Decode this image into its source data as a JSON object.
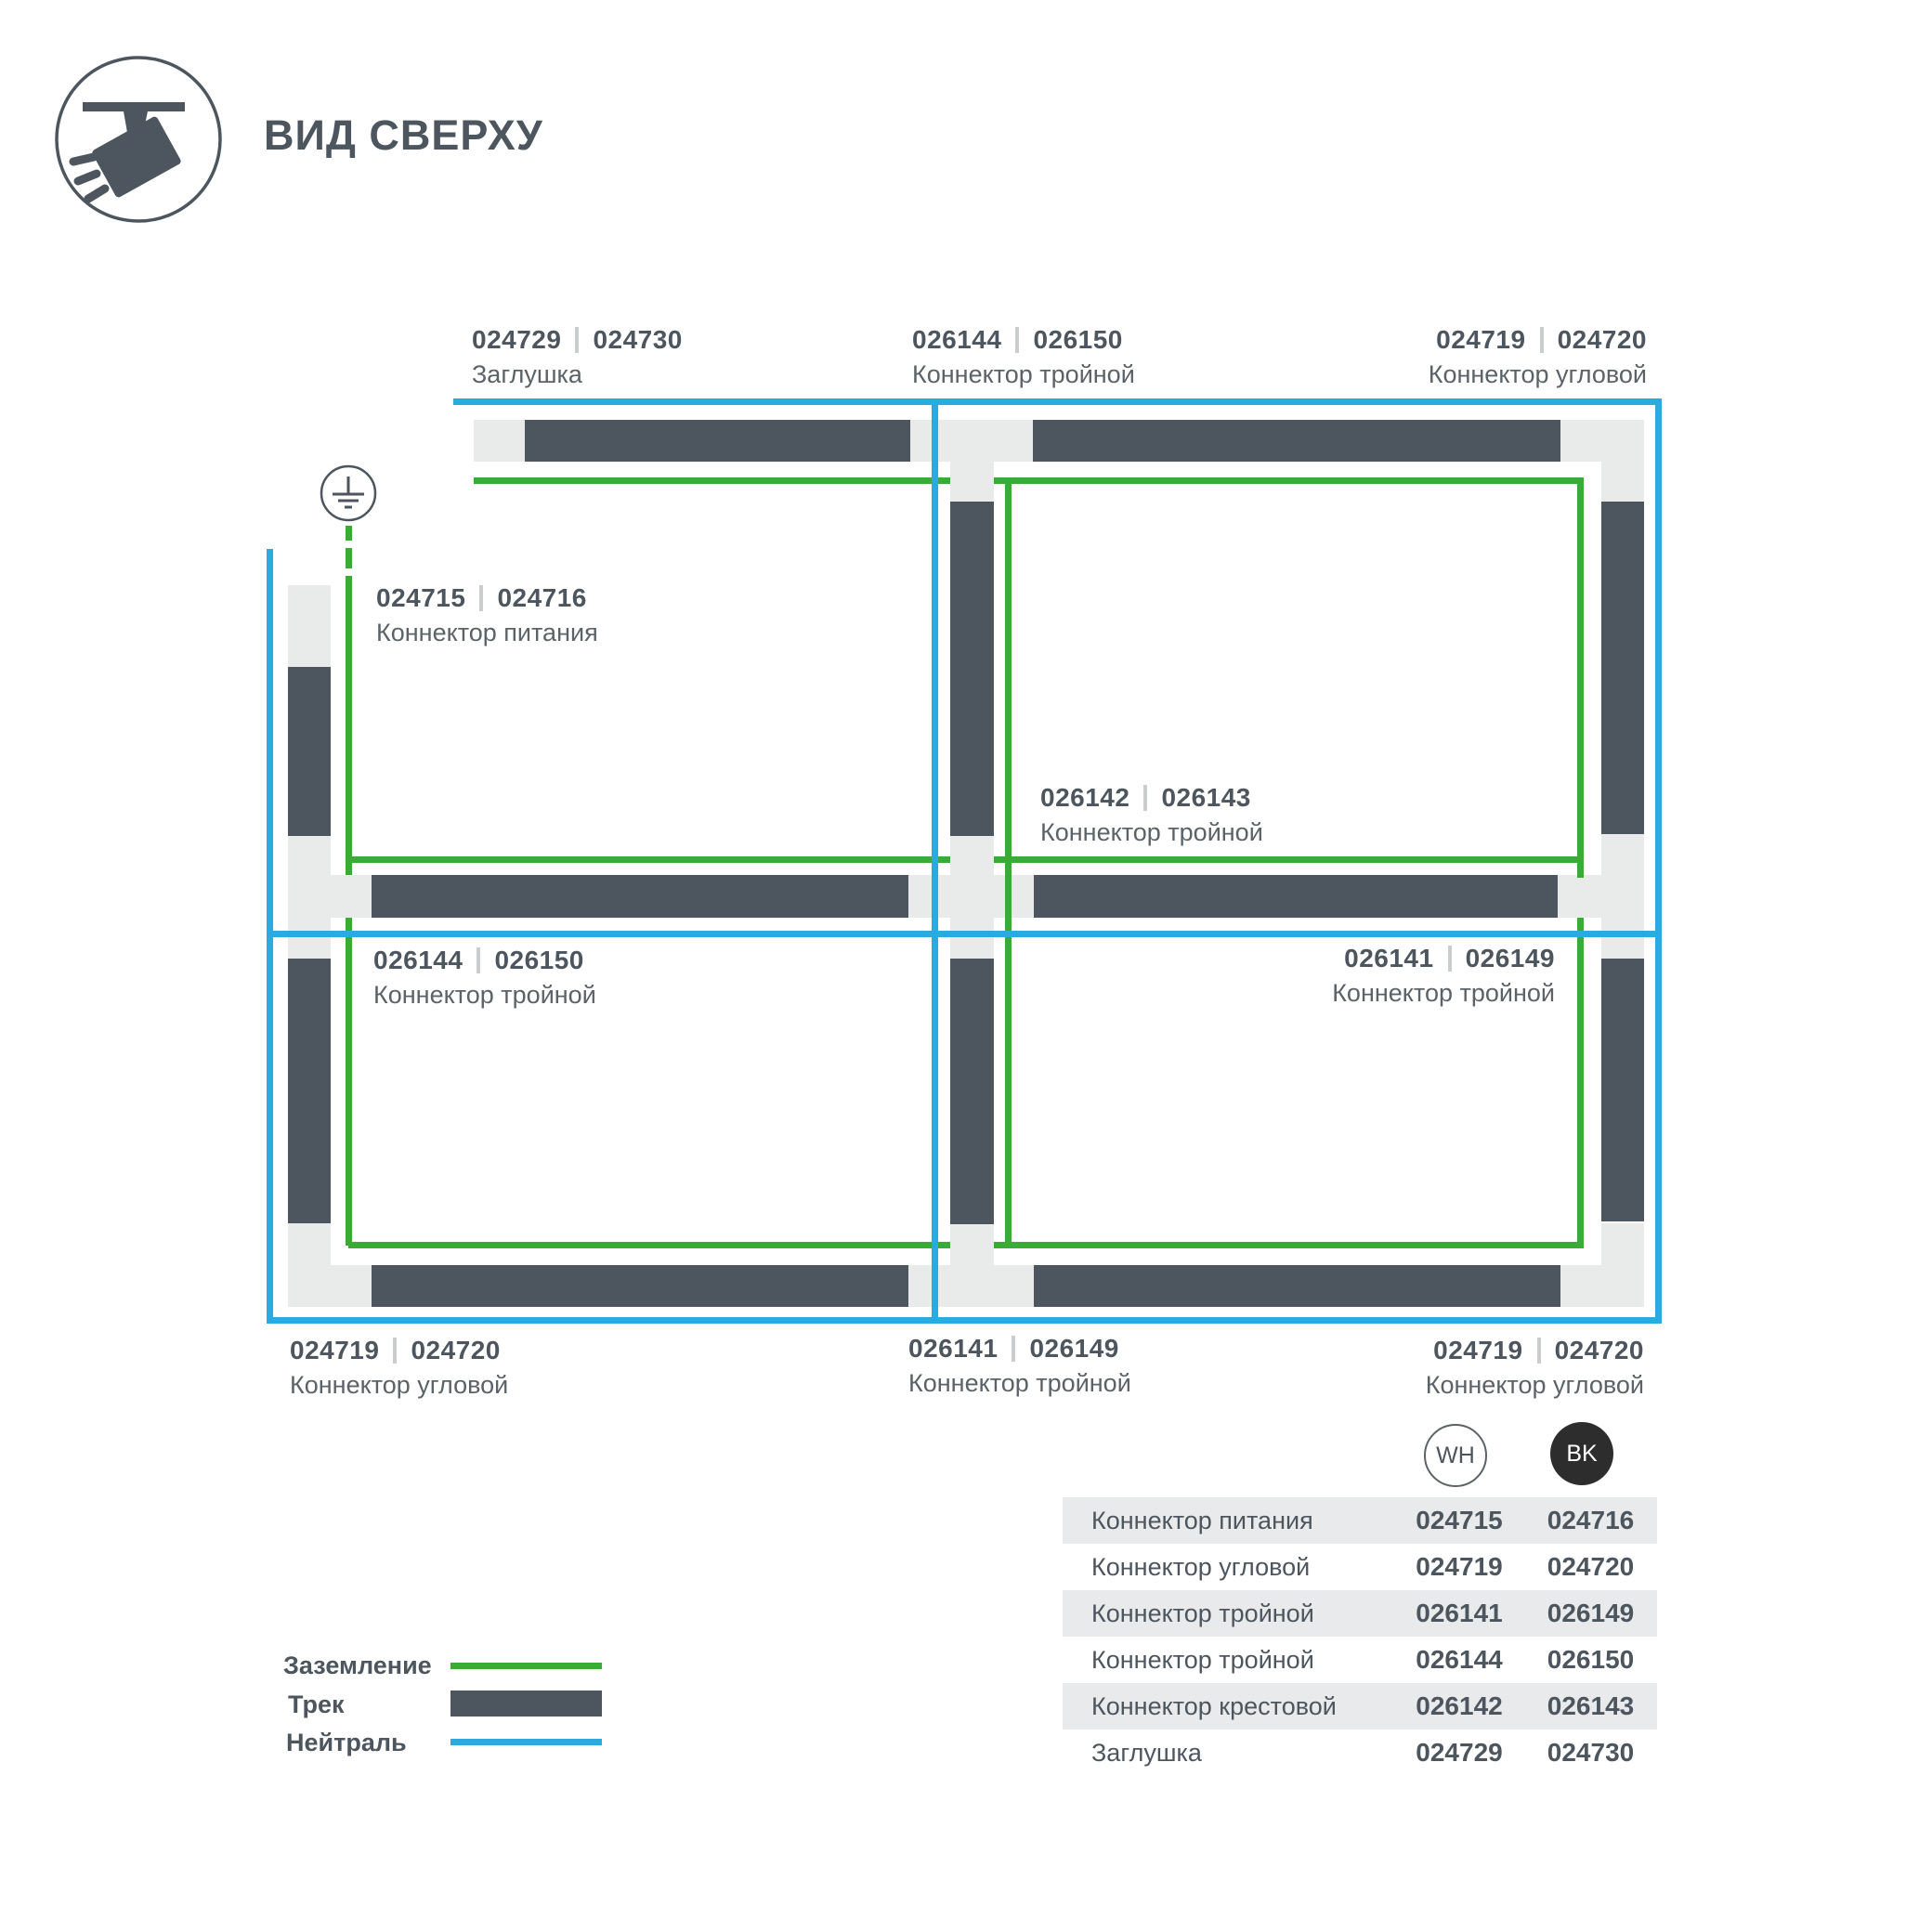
{
  "header": {
    "title": "ВИД СВЕРХУ"
  },
  "colors": {
    "track": "#4d565e",
    "connector_piece": "#e9ebeb",
    "ground_green": "#3aab35",
    "neutral_blue": "#29abe2",
    "text_dark": "#4d565e",
    "text_name": "#5b6368",
    "separator": "#c9cdcd",
    "table_row_shade": "#e8eaeb",
    "badge_bk_bg": "#2d2d2d"
  },
  "diagram": {
    "ground_symbol": "earth-ground",
    "labels": [
      {
        "id": "cap-top",
        "codes": [
          "024729",
          "024730"
        ],
        "name": "Заглушка"
      },
      {
        "id": "tee-top",
        "codes": [
          "026144",
          "026150"
        ],
        "name": "Коннектор тройной"
      },
      {
        "id": "corner-top-right",
        "codes": [
          "024719",
          "024720"
        ],
        "name": "Коннектор угловой"
      },
      {
        "id": "power-feed",
        "codes": [
          "024715",
          "024716"
        ],
        "name": "Коннектор питания"
      },
      {
        "id": "cross-center",
        "codes": [
          "026142",
          "026143"
        ],
        "name": "Коннектор тройной"
      },
      {
        "id": "tee-mid-left",
        "codes": [
          "026144",
          "026150"
        ],
        "name": "Коннектор тройной"
      },
      {
        "id": "tee-mid-right",
        "codes": [
          "026141",
          "026149"
        ],
        "name": "Коннектор тройной"
      },
      {
        "id": "corner-bottom-left",
        "codes": [
          "024719",
          "024720"
        ],
        "name": "Коннектор угловой"
      },
      {
        "id": "tee-bottom",
        "codes": [
          "026141",
          "026149"
        ],
        "name": "Коннектор тройной"
      },
      {
        "id": "corner-bottom-right",
        "codes": [
          "024719",
          "024720"
        ],
        "name": "Коннектор угловой"
      }
    ]
  },
  "legend": {
    "items": [
      {
        "label": "Заземление",
        "swatch": "ground-line"
      },
      {
        "label": "Трек",
        "swatch": "track-bar"
      },
      {
        "label": "Нейтраль",
        "swatch": "neutral-line"
      }
    ]
  },
  "table": {
    "columns": [
      {
        "badge": "WH"
      },
      {
        "badge": "BK"
      }
    ],
    "rows": [
      {
        "name": "Коннектор питания",
        "wh": "024715",
        "bk": "024716"
      },
      {
        "name": "Коннектор угловой",
        "wh": "024719",
        "bk": "024720"
      },
      {
        "name": "Коннектор тройной",
        "wh": "026141",
        "bk": "026149"
      },
      {
        "name": "Коннектор тройной",
        "wh": "026144",
        "bk": "026150"
      },
      {
        "name": "Коннектор крестовой",
        "wh": "026142",
        "bk": "026143"
      },
      {
        "name": "Заглушка",
        "wh": "024729",
        "bk": "024730"
      }
    ]
  }
}
